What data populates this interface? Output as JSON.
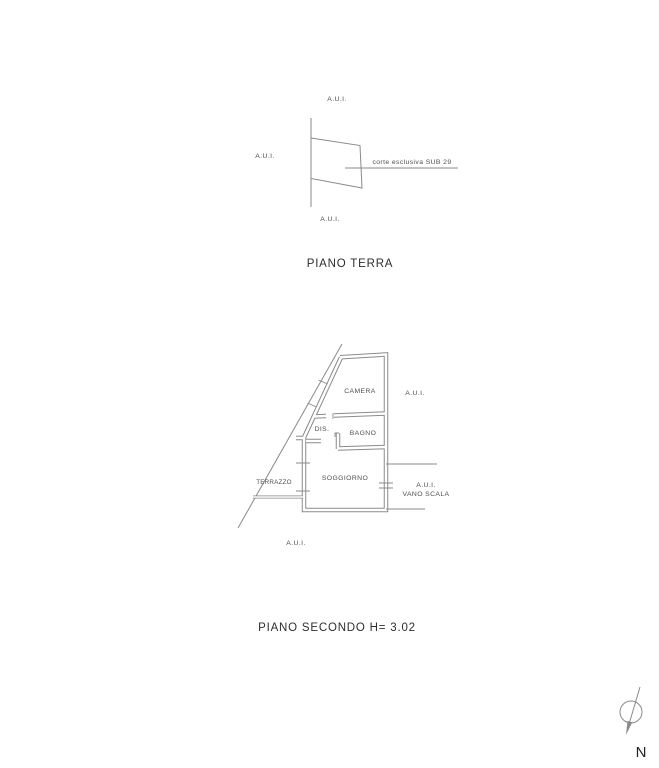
{
  "page": {
    "background": "#ffffff",
    "line_color": "#8a8a8a",
    "label_color": "#4f4f4f",
    "title_color": "#2e2e2e"
  },
  "ground_floor": {
    "title": "PIANO TERRA",
    "labels": {
      "aui_top": "A.U.I.",
      "aui_left": "A.U.I.",
      "aui_bottom": "A.U.I.",
      "corte_leader": "corte esclusiva SUB 29"
    }
  },
  "second_floor": {
    "title": "PIANO SECONDO  H= 3.02",
    "rooms": {
      "camera": "CAMERA",
      "dis": "DIS.",
      "bagno": "BAGNO",
      "soggiorno": "SOGGIORNO",
      "terrazzo": "TERRAZZO"
    },
    "labels": {
      "aui_right": "A.U.I.",
      "aui_stair": "A.U.I.",
      "vano_scala": "VANO SCALA",
      "aui_bottom": "A.U.I."
    }
  },
  "compass": {
    "north_label": "N"
  }
}
